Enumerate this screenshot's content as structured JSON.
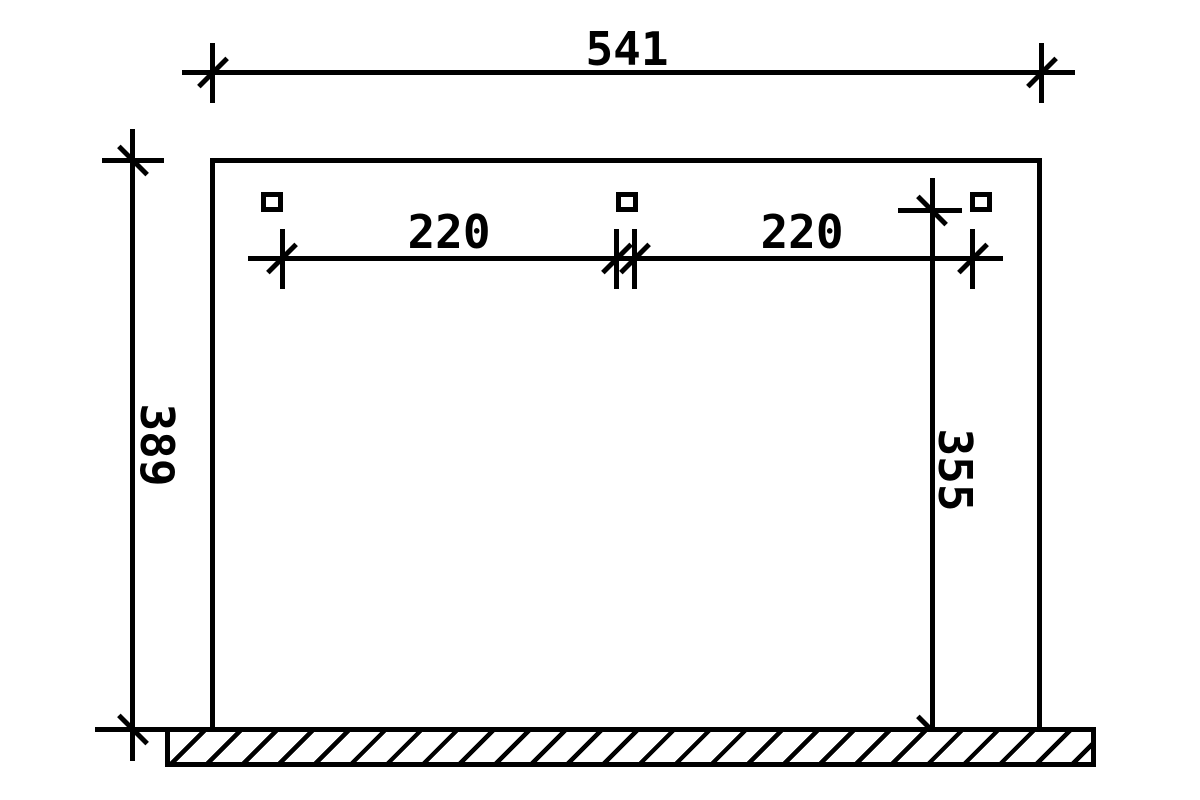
{
  "drawing": {
    "kind": "technical elevation drawing with dimensions",
    "colors": {
      "line": "#000000",
      "background": "#ffffff"
    },
    "dimensions": {
      "overall_width": "541",
      "height_left": "389",
      "height_right": "355",
      "bay_left": "220",
      "bay_right": "220"
    }
  }
}
